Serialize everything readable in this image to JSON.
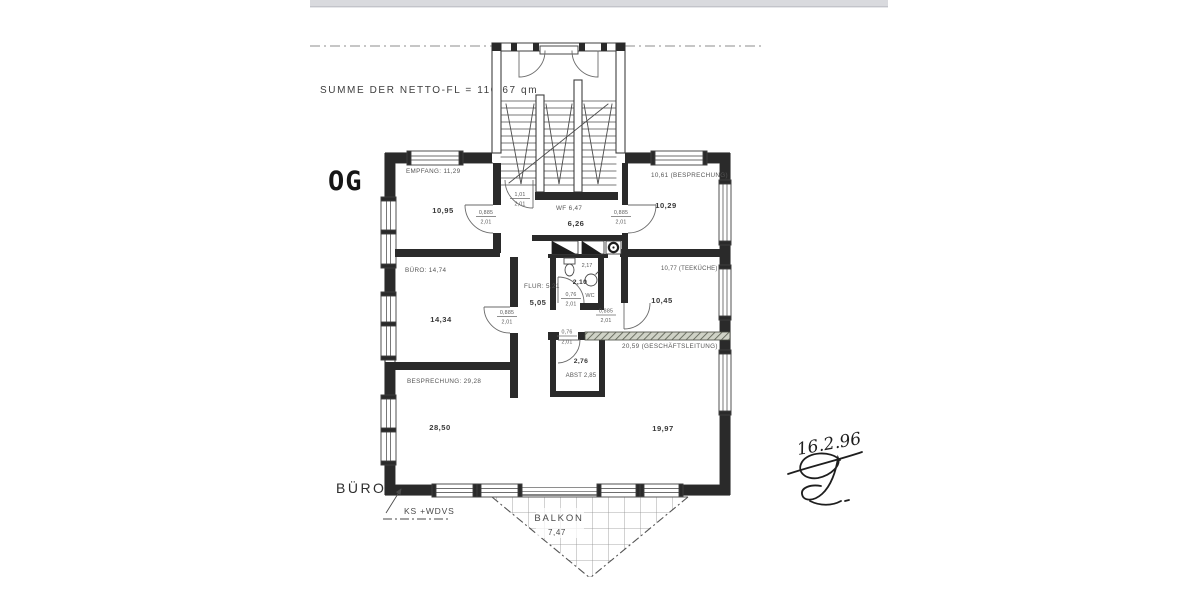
{
  "scan": {
    "summary": "SUMME DER NETTO-FL   =   110,67 qm",
    "floor_mark": "OG",
    "date_hand": "16.2.96"
  },
  "plan": {
    "building_label": "BÜRO",
    "construction_note": "KS +WDVS",
    "rooms": [
      {
        "name": "empfang",
        "label": "EMPFANG: 11,29",
        "area": "10,95"
      },
      {
        "name": "windfang",
        "label": "WF  6,47",
        "area": "6,26"
      },
      {
        "name": "besprechung-oben",
        "label": "10,61  (BESPRECHUNG)",
        "area": "10,29"
      },
      {
        "name": "buero",
        "label": "BÜRO: 14,74",
        "area": "14,34"
      },
      {
        "name": "flur",
        "label": "FLUR: 5,21",
        "area": "5,05"
      },
      {
        "name": "wc",
        "label": "WC",
        "area": "2,10",
        "width_dim": "2,17"
      },
      {
        "name": "teekueche",
        "label": "10,77  (TEEKÜCHE)",
        "area": "10,45"
      },
      {
        "name": "abstellraum",
        "label": "ABST  2,85",
        "area": "2,76"
      },
      {
        "name": "besprechung-unten",
        "label": "BESPRECHUNG: 29,28",
        "area": "28,50"
      },
      {
        "name": "geschaeftsleitung",
        "label": "20,59   (GESCHÄFTSLEITUNG)",
        "area": "19,97"
      },
      {
        "name": "balkon",
        "label": "BALKON",
        "area": "7,47"
      }
    ],
    "doors": [
      {
        "name": "wohnungseingang",
        "w": "1,01",
        "h": "2,01"
      },
      {
        "name": "empfang",
        "w": "0,885",
        "h": "2,01"
      },
      {
        "name": "besprechung-oben",
        "w": "0,885",
        "h": "2,01"
      },
      {
        "name": "buero",
        "w": "0,885",
        "h": "2,01"
      },
      {
        "name": "wc",
        "w": "0,76",
        "h": "2,01"
      },
      {
        "name": "teekueche",
        "w": "0,885",
        "h": "2,01"
      },
      {
        "name": "abstellraum",
        "w": "0,76",
        "h": "2,01"
      }
    ],
    "colors": {
      "ink": "#3d3d3d",
      "wall": "#2a2a2a",
      "paper": "#ffffff",
      "scan_strip": "#d9dade"
    }
  }
}
